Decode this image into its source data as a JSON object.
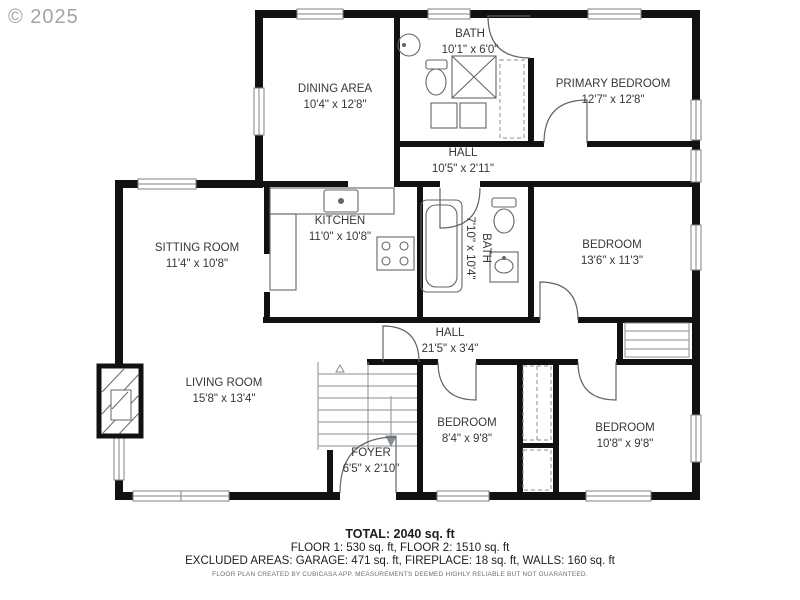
{
  "watermark": "© 2025",
  "rooms": {
    "dining": {
      "name": "DINING AREA",
      "dims": "10'4\" x 12'8\""
    },
    "bath_upper": {
      "name": "BATH",
      "dims": "10'1\" x 6'0\""
    },
    "primary": {
      "name": "PRIMARY BEDROOM",
      "dims": "12'7\" x 12'8\""
    },
    "hall_upper": {
      "name": "HALL",
      "dims": "10'5\" x 2'11\""
    },
    "kitchen": {
      "name": "KITCHEN",
      "dims": "11'0\" x 10'8\""
    },
    "sitting": {
      "name": "SITTING ROOM",
      "dims": "11'4\" x 10'8\""
    },
    "bath_main": {
      "name": "BATH",
      "dims": "7'10\" x 10'4\""
    },
    "bedroom_ne": {
      "name": "BEDROOM",
      "dims": "13'6\" x 11'3\""
    },
    "hall_lower": {
      "name": "HALL",
      "dims": "21'5\" x 3'4\""
    },
    "living": {
      "name": "LIVING ROOM",
      "dims": "15'8\" x 13'4\""
    },
    "foyer": {
      "name": "FOYER",
      "dims": "6'5\" x 2'10\""
    },
    "bedroom_s": {
      "name": "BEDROOM",
      "dims": "8'4\" x 9'8\""
    },
    "bedroom_se": {
      "name": "BEDROOM",
      "dims": "10'8\" x 9'8\""
    }
  },
  "footer": {
    "total": "TOTAL: 2040 sq. ft",
    "floors": "FLOOR 1: 530 sq. ft, FLOOR 2: 1510 sq. ft",
    "excluded": "EXCLUDED AREAS: GARAGE: 471 sq. ft, FIREPLACE: 18 sq. ft, WALLS: 160 sq. ft",
    "disclaimer": "FLOOR PLAN CREATED BY CUBICASA APP. MEASUREMENTS DEEMED HIGHLY RELIABLE BUT NOT GUARANTEED."
  },
  "colors": {
    "wall": "#111111",
    "background": "#ffffff",
    "fixture_line": "#666666",
    "watermark": "#a3a3a3"
  }
}
